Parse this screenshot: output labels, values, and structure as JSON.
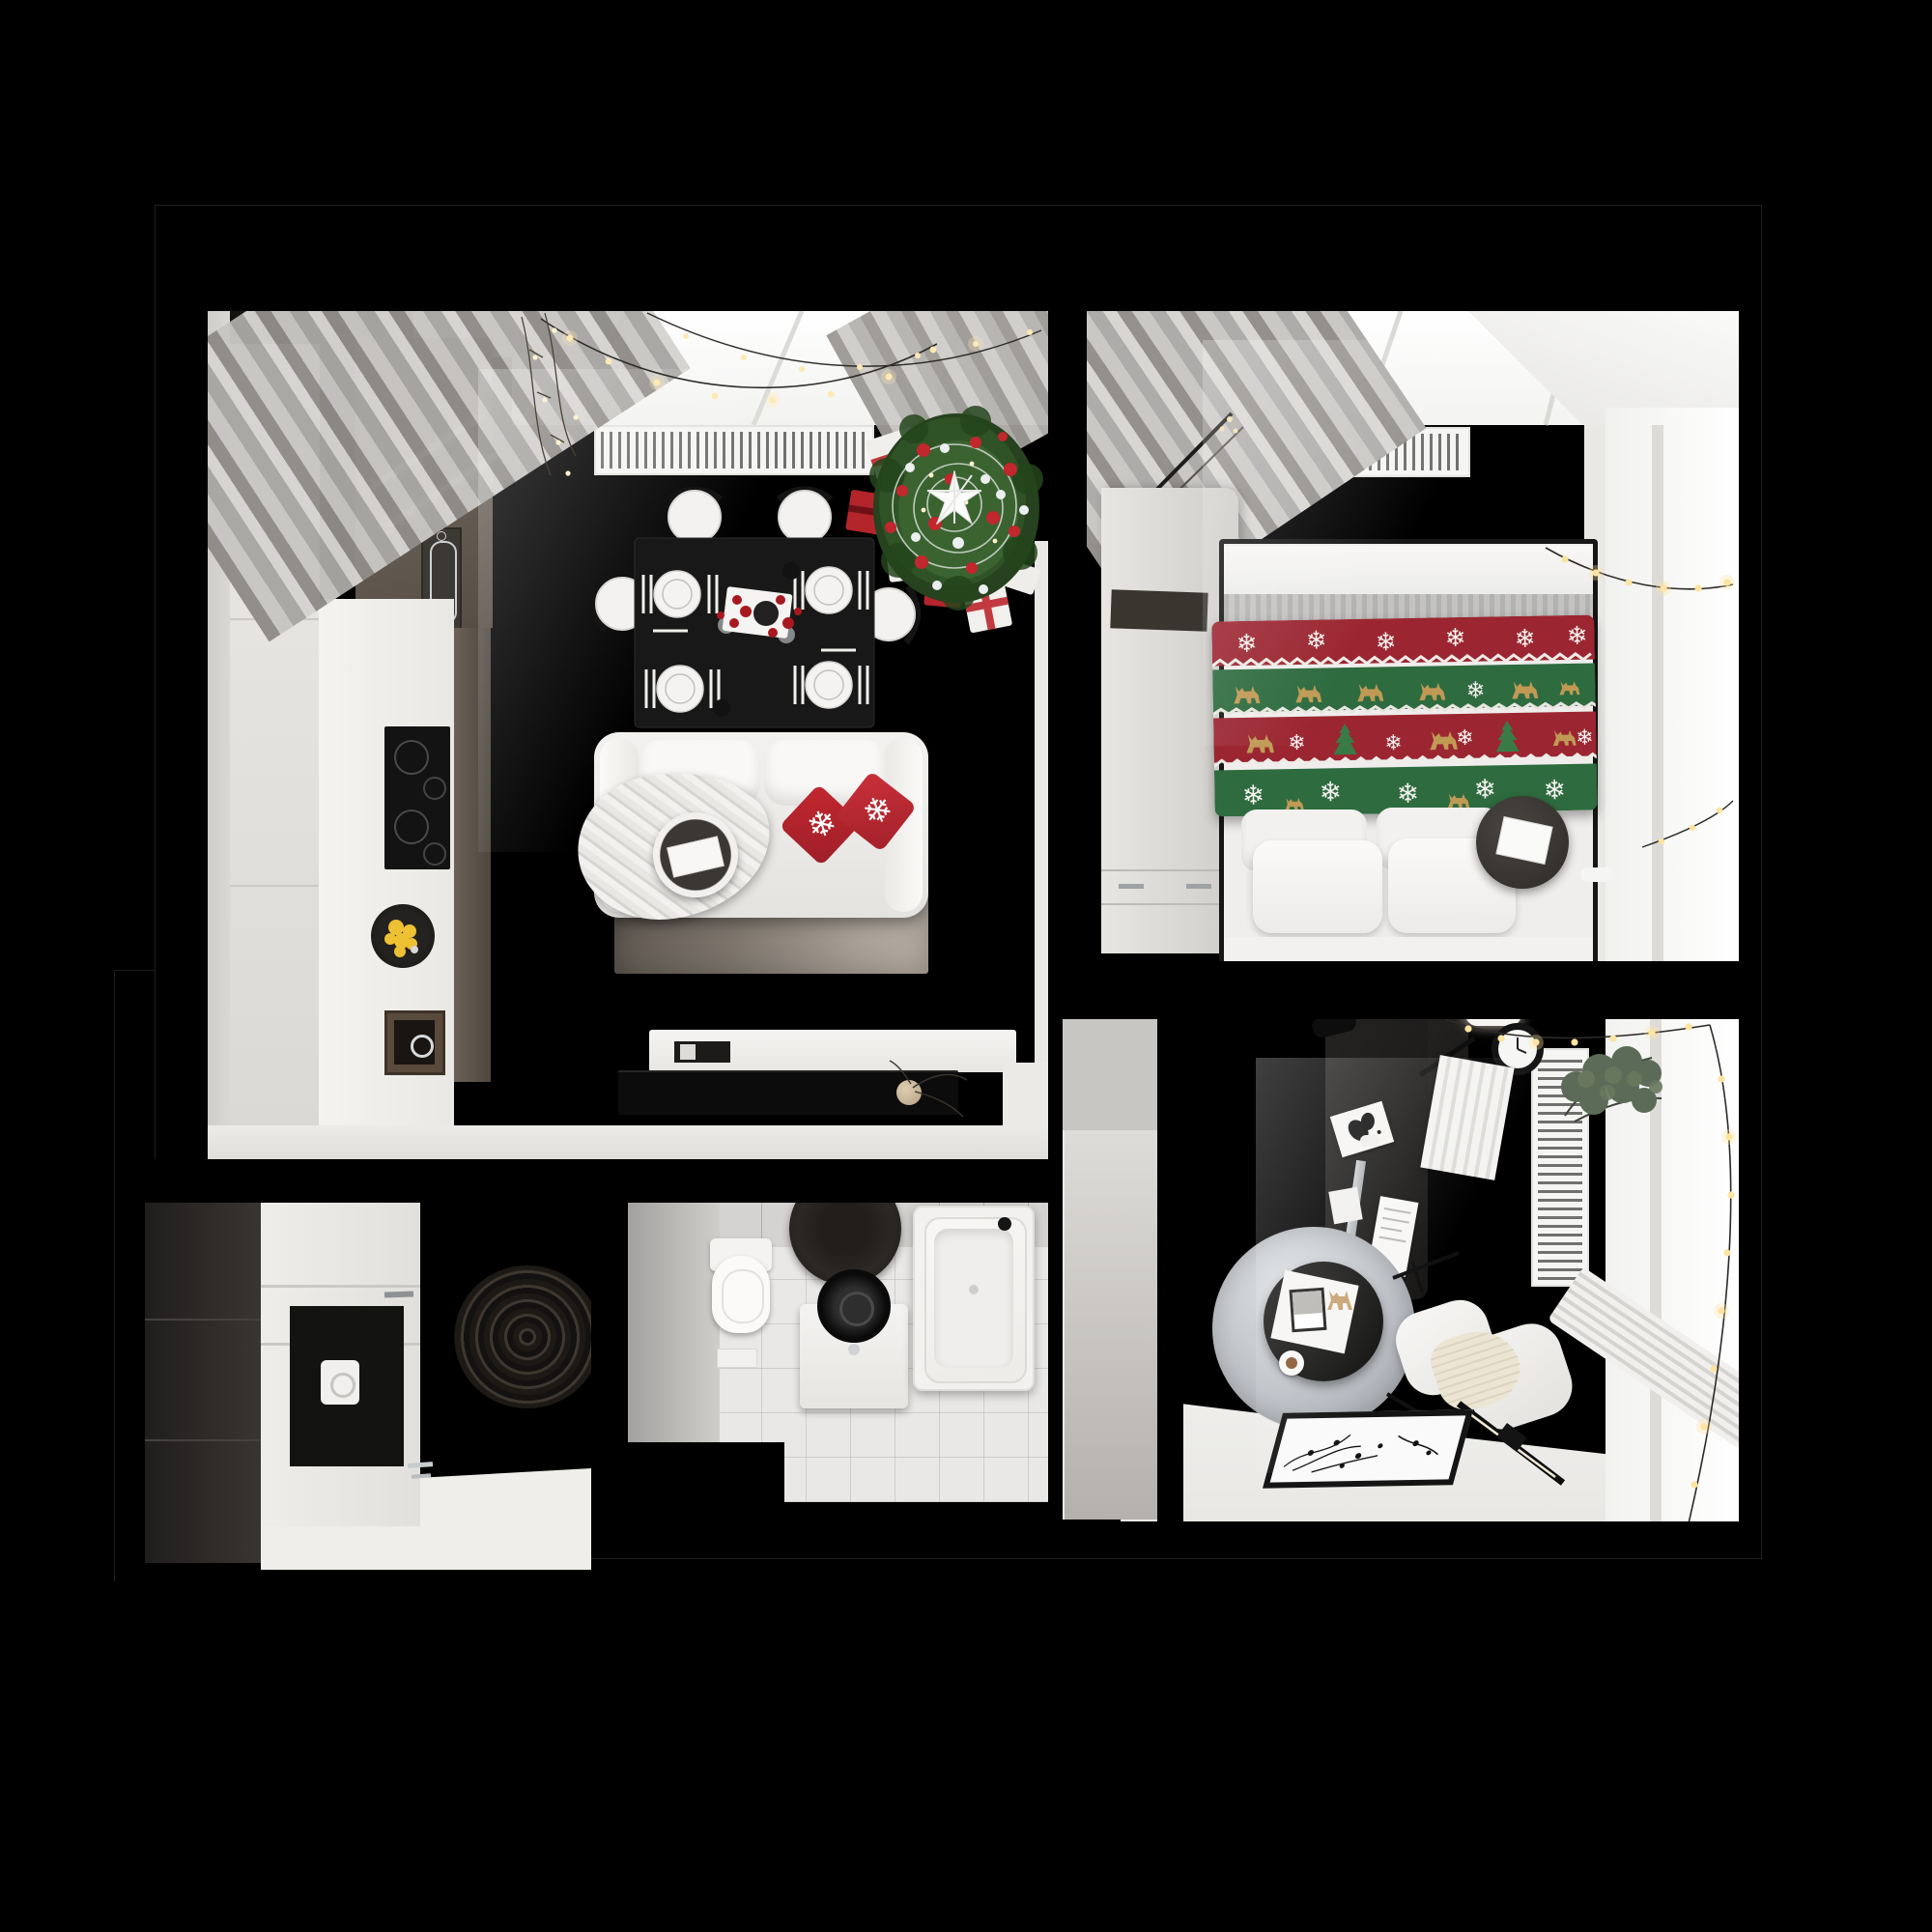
{
  "meta": {
    "title": "Top-view 3D apartment floor plan decorated for Christmas",
    "background": "#000000"
  },
  "palette": {
    "wood_floor": "#e6d3ab",
    "white_surface": "#f2f1ee",
    "wall_white": "#e8e7e4",
    "wall_black": "#000000",
    "curtain_gray": "#b7b5b2",
    "rug_living": "#6e665e",
    "accent_red": "#b3242b",
    "tree_green": "#2c4d24",
    "blanket_red": "#9b2631",
    "blanket_green": "#2e6b3f",
    "deer_gold": "#c09a55",
    "light_warm": "#ffe4a8",
    "office_rug_gray": "#bcc0c5",
    "tile_gray": "#e9e8e6",
    "dark_furniture": "#1c1b1a"
  },
  "rooms": [
    {
      "id": "living-kitchen",
      "name": "living-room-kitchen",
      "items": [
        "kitchen-tall-cabinet",
        "dark-cabinets",
        "oven",
        "induction-cooktop",
        "fruit-bowl",
        "sink",
        "dining-table-for-four",
        "plates",
        "chairs",
        "christmas-tree",
        "gift-boxes",
        "sofa",
        "red-snowflake-pillows",
        "knit-throw",
        "side-stool",
        "area-rug",
        "tv-console",
        "tv",
        "radiator",
        "curtains",
        "window-string-lights"
      ]
    },
    {
      "id": "bedroom",
      "name": "bedroom",
      "items": [
        "wardrobe",
        "double-bed",
        "christmas-knit-blanket",
        "pillows",
        "bedside-table",
        "radiator-top",
        "radiator-side",
        "window",
        "garland",
        "curtain"
      ]
    },
    {
      "id": "office",
      "name": "home-office",
      "items": [
        "desk",
        "desk-lamp",
        "wall-clock",
        "eucalyptus-plant",
        "paper-blind",
        "round-rug",
        "coffee-table",
        "coffee-cup",
        "armchair",
        "waffle-throw",
        "linear-floor-lamp",
        "picture-frame",
        "radiator",
        "window",
        "garland"
      ]
    },
    {
      "id": "bathroom",
      "name": "bathroom",
      "items": [
        "wall-hung-toilet",
        "round-mat",
        "washing-machine",
        "bathtub",
        "shelf",
        "flush-plate"
      ]
    },
    {
      "id": "hallway",
      "name": "hallway",
      "items": [
        "dark-wardrobe",
        "white-dresser",
        "open-niche",
        "coiled-round-rug"
      ]
    },
    {
      "id": "entry",
      "name": "entry-corridor",
      "items": []
    }
  ]
}
